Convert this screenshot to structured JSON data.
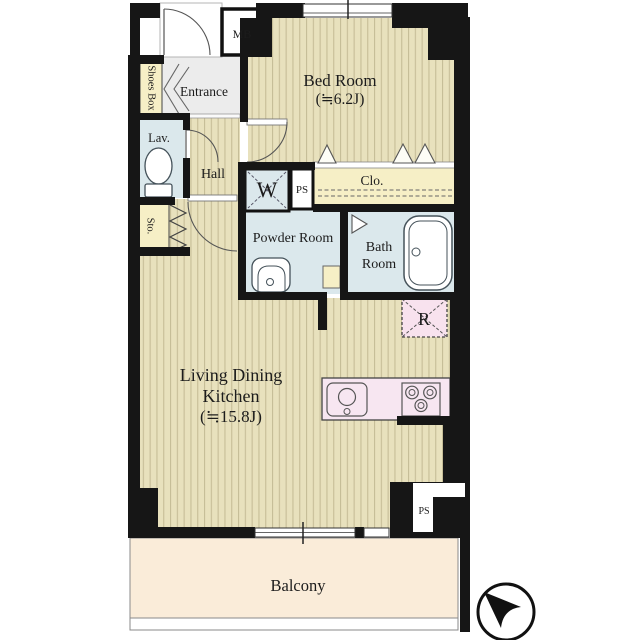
{
  "title": "Apartment floor plan (1LDK)",
  "rooms": {
    "bedroom": {
      "name": "Bed Room",
      "size": "(≒6.2J)"
    },
    "ldk": {
      "line1": "Living Dining",
      "line2": "Kitchen",
      "size": "(≒15.8J)"
    },
    "entrance": {
      "label": "Entrance"
    },
    "shoes_box": {
      "label": "Shoes Box"
    },
    "lavatory": {
      "label": "Lav."
    },
    "hall": {
      "label": "Hall"
    },
    "storage": {
      "label": "Sto."
    },
    "washing_machine": {
      "label": "W"
    },
    "pipe_space_upper": {
      "label": "PS"
    },
    "closet": {
      "label": "Clo."
    },
    "powder_room": {
      "label": "Powder Room"
    },
    "bath_room": {
      "line1": "Bath",
      "line2": "Room"
    },
    "refrigerator": {
      "label": "R"
    },
    "meter_box": {
      "label": "MB"
    },
    "pipe_space_lower": {
      "label": "PS"
    },
    "balcony": {
      "label": "Balcony"
    }
  },
  "colors": {
    "wall": "#161616",
    "striped_floor": "#e8e1bd",
    "floor_stripe": "#c6bd97",
    "wet_area_floor": "#dbe8ec",
    "closet_floor": "#f6efc6",
    "entrance_floor": "#ececec",
    "kitchen_counter": "#f7e6f1",
    "refrigerator_fill": "#f8e2ee",
    "balcony_floor": "#faecd9"
  },
  "icons": {
    "compass": "north-arrow"
  }
}
